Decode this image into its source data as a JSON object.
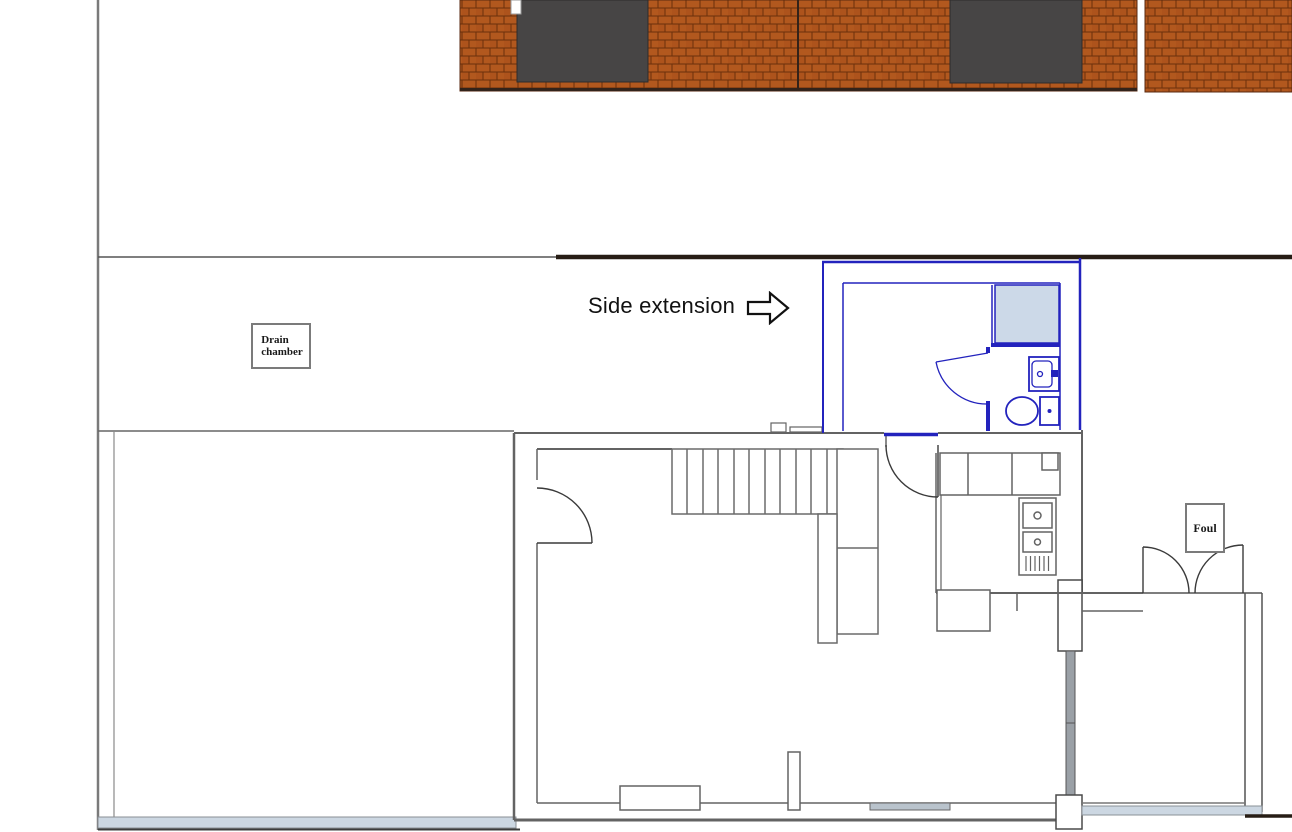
{
  "plan": {
    "annotations": {
      "side_extension_label": "Side extension",
      "drain_chamber_label": "Drain\nchamber",
      "foul_label": "Foul"
    },
    "icons": {
      "direction_arrow": "block-arrow-right"
    },
    "colors": {
      "brick": "#b2581e",
      "mortar": "#6b300c",
      "window_dark": "#474545",
      "extension_blue": "#2323bd",
      "shower_fill": "#ccd9e8",
      "wall_gray": "#636363",
      "boundary_dark": "#271d15",
      "paving_blue": "#ccd7e2",
      "glazing_gray": "#9aa0a6"
    }
  }
}
